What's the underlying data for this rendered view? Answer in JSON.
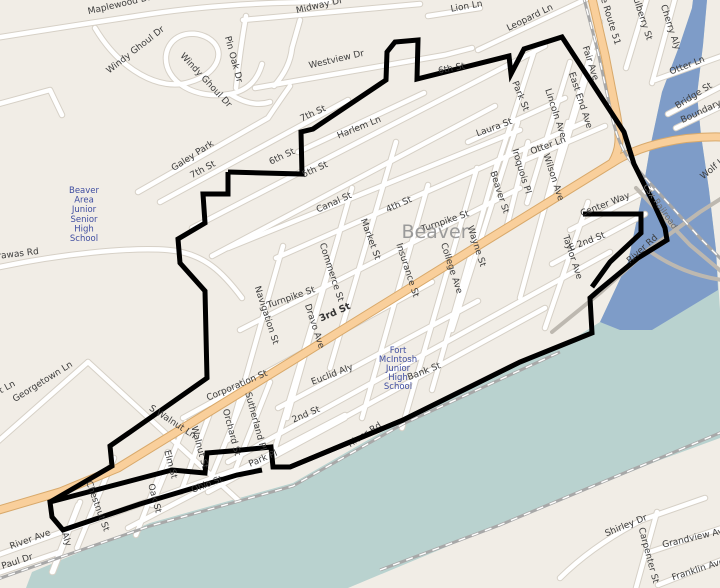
{
  "map": {
    "place_label": "Beaver",
    "route_label": "e Route 51",
    "railroad_label": "Csx Railroad",
    "schools": [
      {
        "name": "Beaver Area Junior Senior High School",
        "lines": [
          "Beaver",
          "Area",
          "Junior",
          "Senior",
          "High",
          "School"
        ],
        "x": 84,
        "y": 193,
        "line_h": 9.6
      },
      {
        "name": "Fort McIntosh Junior High School",
        "lines": [
          "Fort",
          "McIntosh",
          "Junior",
          "High",
          "School"
        ],
        "x": 398,
        "y": 353,
        "line_h": 9.0
      }
    ],
    "street_labels": [
      {
        "t": "Maplewood Dr",
        "x": 120,
        "y": 7,
        "r": -13
      },
      {
        "t": "Windy Ghoul Dr",
        "x": 137,
        "y": 52,
        "r": -38
      },
      {
        "t": "Windy Ghoul Dr",
        "x": 204,
        "y": 82,
        "r": 47
      },
      {
        "t": "Pin Oak Dr",
        "x": 231,
        "y": 60,
        "r": 75
      },
      {
        "t": "Midway Dr",
        "x": 320,
        "y": 8,
        "r": -13
      },
      {
        "t": "Lion Ln",
        "x": 467,
        "y": 9,
        "r": -10
      },
      {
        "t": "Westview Dr",
        "x": 337,
        "y": 62,
        "r": -13
      },
      {
        "t": "7th St",
        "x": 314,
        "y": 116,
        "r": -24
      },
      {
        "t": "7th St",
        "x": 204,
        "y": 172,
        "r": -28
      },
      {
        "t": "6th St",
        "x": 283,
        "y": 159,
        "r": -25
      },
      {
        "t": "6th St",
        "x": 452,
        "y": 71,
        "r": -11
      },
      {
        "t": "5th St",
        "x": 316,
        "y": 172,
        "r": -24
      },
      {
        "t": "Harlem Ln",
        "x": 360,
        "y": 130,
        "r": -22
      },
      {
        "t": "Galey Park",
        "x": 194,
        "y": 158,
        "r": -33
      },
      {
        "t": "Leopard Ln",
        "x": 531,
        "y": 20,
        "r": -26
      },
      {
        "t": "Mulberry St",
        "x": 639,
        "y": 16,
        "r": 72
      },
      {
        "t": "Cherry Aly",
        "x": 668,
        "y": 28,
        "r": 72
      },
      {
        "t": "Otter Ln",
        "x": 688,
        "y": 68,
        "r": -21
      },
      {
        "t": "Bridge St",
        "x": 695,
        "y": 98,
        "r": -32
      },
      {
        "t": "Boundary",
        "x": 702,
        "y": 114,
        "r": -25
      },
      {
        "t": "Park St",
        "x": 518,
        "y": 97,
        "r": 68
      },
      {
        "t": "Fair Ave",
        "x": 588,
        "y": 64,
        "r": 72
      },
      {
        "t": "East End Ave",
        "x": 578,
        "y": 101,
        "r": 72
      },
      {
        "t": "Lincoln Ave",
        "x": 553,
        "y": 114,
        "r": 72
      },
      {
        "t": "Laura St",
        "x": 495,
        "y": 130,
        "r": -20
      },
      {
        "t": "Otter Ln",
        "x": 549,
        "y": 148,
        "r": -20
      },
      {
        "t": "Iroquois Pl",
        "x": 519,
        "y": 172,
        "r": 73
      },
      {
        "t": "Wilson Ave",
        "x": 551,
        "y": 178,
        "r": 72
      },
      {
        "t": "Beaver St",
        "x": 497,
        "y": 193,
        "r": 72
      },
      {
        "t": "Canal St",
        "x": 335,
        "y": 205,
        "r": -24
      },
      {
        "t": "4th St",
        "x": 400,
        "y": 207,
        "r": -24
      },
      {
        "t": "Market St",
        "x": 368,
        "y": 240,
        "r": 70
      },
      {
        "t": "Turnpike St",
        "x": 446,
        "y": 224,
        "r": -19
      },
      {
        "t": "Turnpike St",
        "x": 292,
        "y": 300,
        "r": -19
      },
      {
        "t": "Wayne St",
        "x": 474,
        "y": 247,
        "r": 72
      },
      {
        "t": "College Ave",
        "x": 449,
        "y": 269,
        "r": 72
      },
      {
        "t": "Insurance St",
        "x": 405,
        "y": 271,
        "r": 72
      },
      {
        "t": "Commerce St",
        "x": 329,
        "y": 273,
        "r": 72
      },
      {
        "t": "Navigation St",
        "x": 264,
        "y": 316,
        "r": 72
      },
      {
        "t": "Dravo Ave",
        "x": 312,
        "y": 327,
        "r": 72
      },
      {
        "t": "Center Way",
        "x": 606,
        "y": 207,
        "r": -21
      },
      {
        "t": "E 2nd St",
        "x": 588,
        "y": 244,
        "r": -21
      },
      {
        "t": "Taylor Ave",
        "x": 570,
        "y": 258,
        "r": 72
      },
      {
        "t": "River Rd",
        "x": 644,
        "y": 251,
        "r": -42
      },
      {
        "t": "Wolf Ln",
        "x": 716,
        "y": 169,
        "r": -40
      },
      {
        "t": "Corporation St",
        "x": 238,
        "y": 388,
        "r": -23
      },
      {
        "t": "Euclid Aly",
        "x": 333,
        "y": 377,
        "r": -21
      },
      {
        "t": "Bank St",
        "x": 425,
        "y": 374,
        "r": -21
      },
      {
        "t": "2nd St",
        "x": 307,
        "y": 417,
        "r": -23
      },
      {
        "t": "Sutherland Pl",
        "x": 253,
        "y": 422,
        "r": 75
      },
      {
        "t": "Orchard St",
        "x": 229,
        "y": 433,
        "r": 75
      },
      {
        "t": "Park Pl",
        "x": 264,
        "y": 461,
        "r": -23
      },
      {
        "t": "Ohio St",
        "x": 208,
        "y": 487,
        "r": -21
      },
      {
        "t": "Walnut St",
        "x": 197,
        "y": 448,
        "r": 75
      },
      {
        "t": "Elm St",
        "x": 168,
        "y": 465,
        "r": 75
      },
      {
        "t": "Oak St",
        "x": 152,
        "y": 499,
        "r": 75
      },
      {
        "t": "Chestnut St",
        "x": 95,
        "y": 507,
        "r": 70
      },
      {
        "t": "Aly",
        "x": 64,
        "y": 540,
        "r": 72
      },
      {
        "t": "River Ave",
        "x": 31,
        "y": 542,
        "r": -20
      },
      {
        "t": "Paul Dr",
        "x": 18,
        "y": 564,
        "r": -18
      },
      {
        "t": "Georgetown Ln",
        "x": 44,
        "y": 384,
        "r": -32
      },
      {
        "t": "S Walnut Ln",
        "x": 171,
        "y": 424,
        "r": 33
      },
      {
        "t": "Walnut Ln",
        "x": -4,
        "y": 396,
        "r": -28
      },
      {
        "t": "Tuscarawas Rd",
        "x": 6,
        "y": 258,
        "r": -7
      },
      {
        "t": "River Rd",
        "x": 366,
        "y": 437,
        "r": -33
      },
      {
        "t": "Shirley Dr",
        "x": 627,
        "y": 528,
        "r": -22
      },
      {
        "t": "Carpenter St",
        "x": 646,
        "y": 556,
        "r": 75
      },
      {
        "t": "Grandview Ave",
        "x": 696,
        "y": 540,
        "r": -13
      },
      {
        "t": "Franklin Ave",
        "x": 699,
        "y": 572,
        "r": -18
      }
    ],
    "special_labels": [
      {
        "t": "e Route 51",
        "x": 608,
        "y": 22,
        "r": 73,
        "cls": "lbl"
      },
      {
        "t": "3rd St",
        "x": 336,
        "y": 315,
        "r": -24,
        "cls": "lbl-bold"
      },
      {
        "t": "Csx Railroad",
        "x": 658,
        "y": 208,
        "r": 55,
        "cls": "lbl-rr"
      },
      {
        "t": "Beaver",
        "x": 435,
        "y": 238,
        "r": 0,
        "cls": "lbl-city"
      }
    ],
    "colors": {
      "land": "#f1ede6",
      "road_fill": "#ffffff",
      "road_casing": "#d6d0c6",
      "orange_fill": "#f9cf9b",
      "orange_casing": "#d8a96b",
      "gray_road": "#bdb8b0",
      "river": "#b9d2cf",
      "beaver_arm": "#7e9cc8",
      "rail": "#a8a8a8",
      "boundary": "#000000"
    }
  }
}
